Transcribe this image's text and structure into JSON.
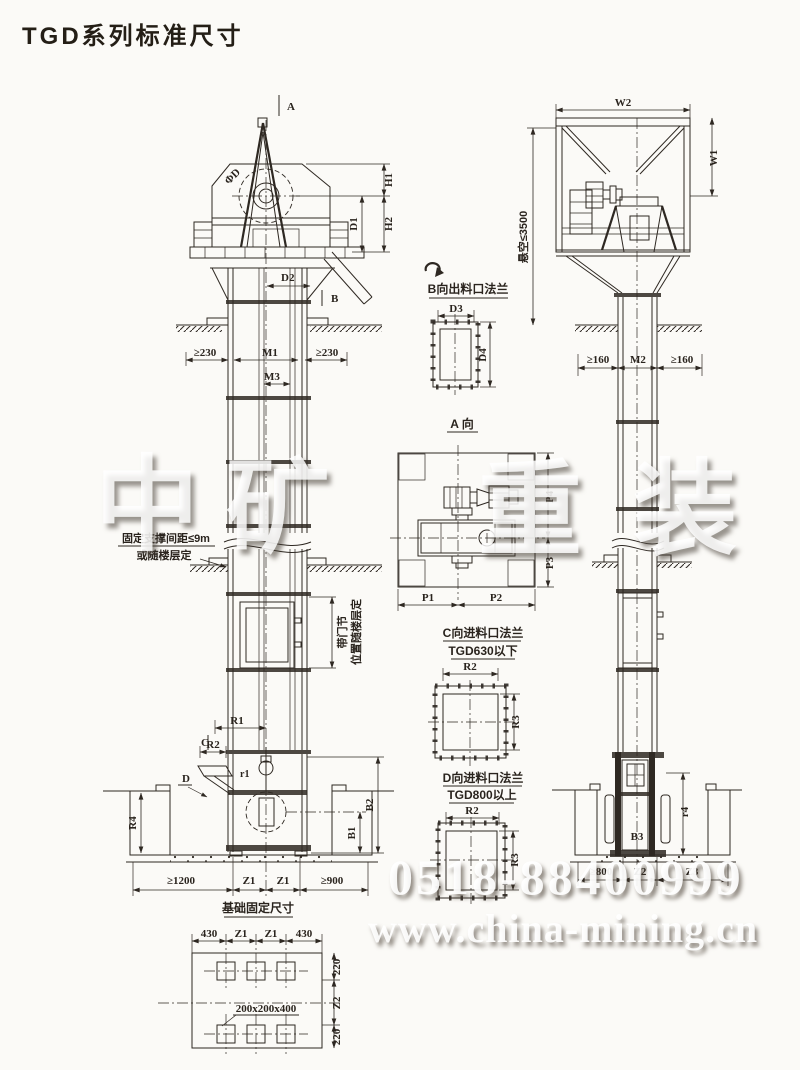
{
  "title": "TGD系列标准尺寸",
  "colors": {
    "line": "#2e2822",
    "paper": "#fbfaf7"
  },
  "watermark": {
    "chars": [
      "中",
      "矿",
      "重",
      "装"
    ],
    "phone": "0518-88400999",
    "website": "www.china-mining.cn"
  },
  "front_view": {
    "section_a": "A",
    "section_b": "B",
    "label_c": "C",
    "label_d": "D",
    "pulley_diameter": "ΦD",
    "h1": "H1",
    "h2": "H2",
    "d1": "D1",
    "d2": "D2",
    "m1": "M1",
    "m3": "M3",
    "floor_clearance_left": "≥230",
    "floor_clearance_right": "≥230",
    "support_note_line1": "固定支撑间距≤9m",
    "support_note_line2": "或随楼层定",
    "door_section_note_line1": "带门节",
    "door_section_note_line2": "位置随楼层定",
    "r1": "R1",
    "r2": "R2",
    "r1_small": "r1",
    "r4": "R4",
    "b1": "B1",
    "b2": "B2",
    "base_dim_left": "≥1200",
    "base_dim_z1a": "Z1",
    "base_dim_z1b": "Z1",
    "base_dim_right": "≥900"
  },
  "foundation_plan": {
    "title": "基础固定尺寸",
    "top_dims": [
      "430",
      "Z1",
      "Z1",
      "430"
    ],
    "right_dims": [
      "220",
      "Z2",
      "220"
    ],
    "anchor_pocket": "200x200x400"
  },
  "detail_views": {
    "outlet_flange_b": {
      "title": "B向出料口法兰",
      "d3": "D3",
      "d4": "D4"
    },
    "view_a": {
      "title": "A 向",
      "p1": "P1",
      "p2": "P2",
      "p3": "P3",
      "p4": "P4"
    },
    "inlet_flange_c": {
      "title": "C向进料口法兰",
      "subtitle": "TGD630以下",
      "r2": "R2",
      "r3": "R3"
    },
    "inlet_flange_d": {
      "title": "D向进料口法兰",
      "subtitle": "TGD800以上",
      "r2": "R2",
      "r3": "R3"
    }
  },
  "side_view": {
    "w1": "W1",
    "w2": "W2",
    "suspended_height": "悬空≤3500",
    "floor_clearance_left": "≥160",
    "m2": "M2",
    "floor_clearance_right": "≥160",
    "b3": "B3",
    "r4": "r4",
    "base_dim_left": "≥800",
    "z2": "Z2",
    "z3": "Z3"
  }
}
